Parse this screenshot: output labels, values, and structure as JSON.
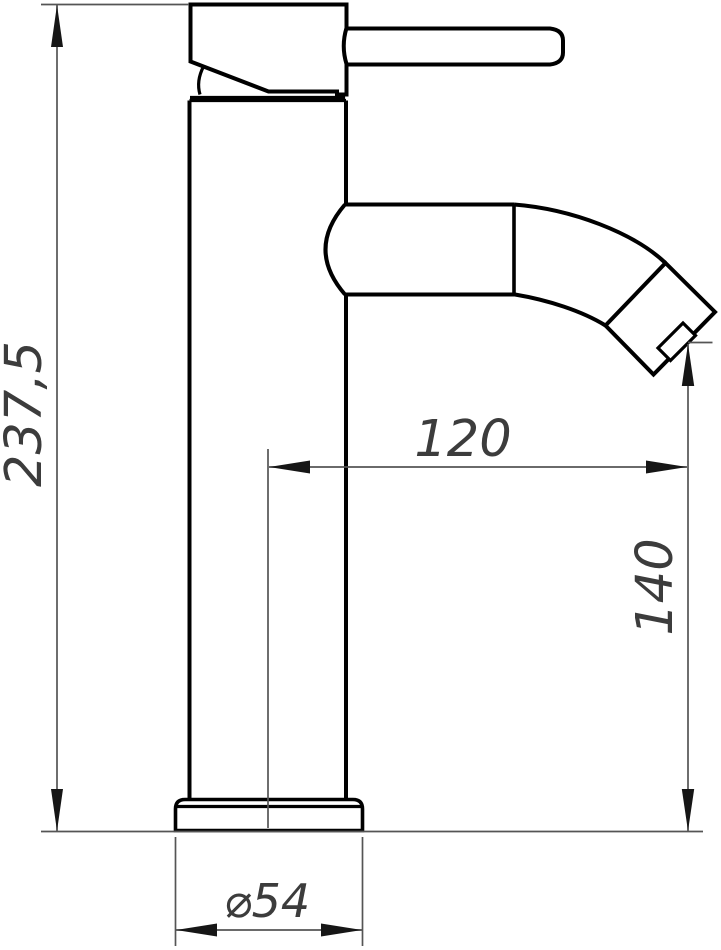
{
  "drawing": {
    "title": "faucet-dimensional-drawing",
    "dimensions": {
      "overall_height": "237,5",
      "spout_reach": "120",
      "outlet_height": "140",
      "base_diameter": "⌀54"
    },
    "colors": {
      "background": "#ffffff",
      "outline": "#000000",
      "dimension_lines": "#555555",
      "arrowheads": "#161616",
      "dimension_text": "#3c3c3c"
    }
  }
}
